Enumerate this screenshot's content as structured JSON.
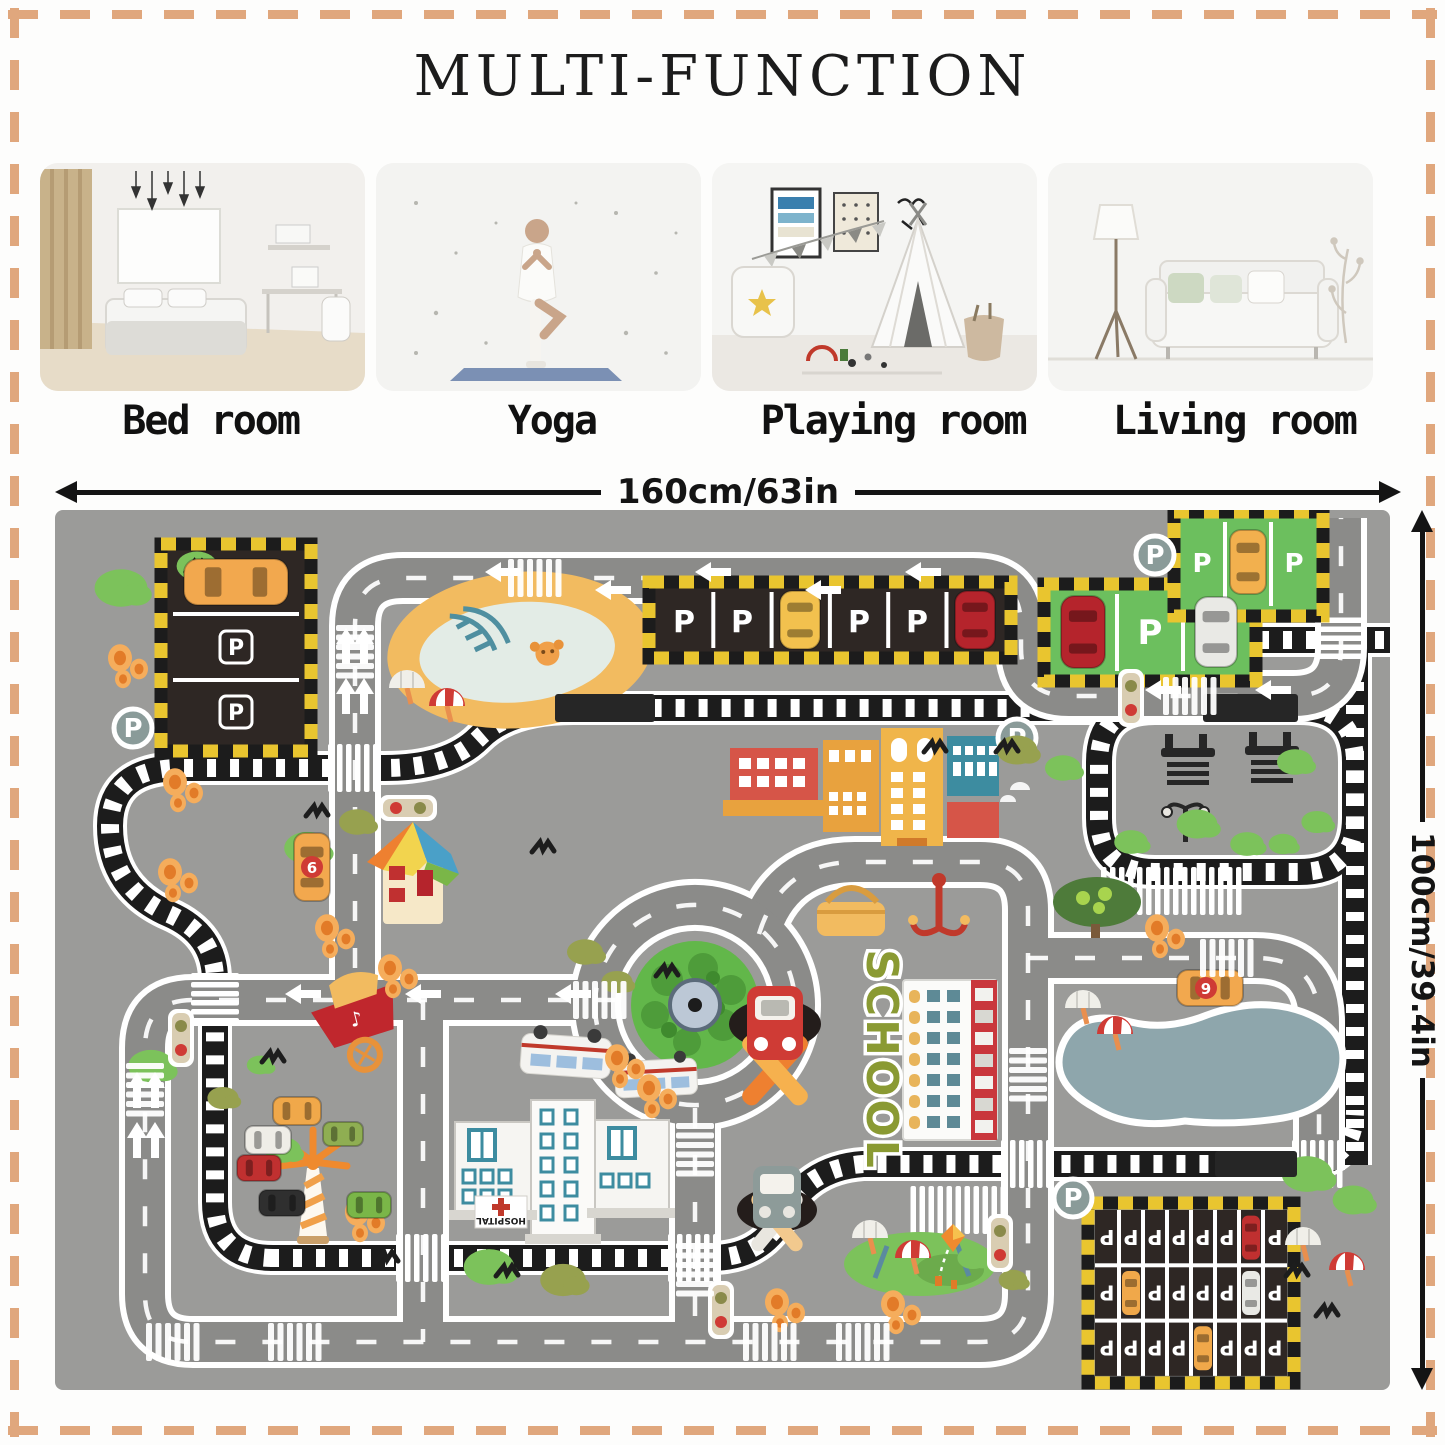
{
  "page": {
    "title": "MULTI-FUNCTION"
  },
  "rooms": [
    {
      "label": "Bed room"
    },
    {
      "label": "Yoga"
    },
    {
      "label": "Playing room"
    },
    {
      "label": "Living room"
    }
  ],
  "dimensions": {
    "width_label": "160cm/63in",
    "height_label": "100cm/39.4in"
  },
  "colors": {
    "frame_dash": "#e0a77d",
    "title_text": "#1c1c1c",
    "mat_bg": "#9b9b99",
    "road": "#8b8b89",
    "road_line": "#ffffff",
    "track": "#1c1c1c",
    "hazard_yellow": "#e9c52f",
    "parking_dark": "#2e2724",
    "parking_green": "#6cbf5e",
    "pond_sand": "#f2bb60",
    "pond_water": "#e3ece6",
    "lake": "#8ea6ac",
    "grass": "#7cc25b",
    "olive": "#97a14f",
    "fruit_orange": "#f0a04a",
    "school_red": "#c9373c",
    "school_text_green": "#8a9a33",
    "hospital_teal": "#3d8ca0",
    "car_yellow": "#f2b04e",
    "car_red": "#b5242c"
  },
  "mat": {
    "p_letter": "P",
    "school_text": "SCHOOL",
    "hospital_text": "HOSPITAL",
    "car_numbers": {
      "house_car": "6",
      "race_car": "9"
    },
    "roads": [
      "M 300,505 L 300,116 Q 300,68 348,68 L 918,68 Q 966,68 966,116 L 966,138 Q 966,186 1014,186 L 1238,186 Q 1286,186 1286,138 L 1286,8",
      "M 560,490 L 138,490 Q 90,490 90,538 L 90,784 Q 90,832 138,832 L 925,832 Q 973,832 973,784 L 973,700",
      "M 368,490 L 368,832",
      "M 640,598 L 640,832",
      "M 704,424 Q 726,352 800,352 L 925,352 Q 973,352 973,400 L 973,710",
      "M 973,448 L 1200,448 Q 1264,448 1264,512 L 1264,660",
      "M 540,495 a 100,100 0 1 0 200,0 a 100,100 0 1 0 -200,0"
    ],
    "tracks": [
      "M 218,748 Q 160,748 160,692 L 160,470 Q 160,424 114,404 Q 55,378 55,316 Q 55,258 126,258 L 330,258 Q 394,258 424,228 Q 454,198 518,198 L 1252,198",
      "M 1100,198 Q 1044,198 1044,252 L 1044,308 Q 1044,362 1100,362 L 1244,362 Q 1300,362 1300,308 L 1300,252 Q 1300,198 1244,198",
      "M 1205,130 L 1340,130",
      "M 1205,130 Q 1128,136 1108,164 Q 1094,192 1136,198",
      "M 1300,126 L 1300,655",
      "M 215,748 L 656,748 Q 704,748 726,710 Q 750,658 808,654 L 1246,654 Q 1300,654 1300,600"
    ],
    "crossings": [
      [
        300,
        258,
        0,
        6
      ],
      [
        160,
        490,
        90,
        6
      ],
      [
        640,
        748,
        0,
        6
      ],
      [
        973,
        654,
        0,
        6
      ],
      [
        1264,
        654,
        0,
        6
      ],
      [
        368,
        748,
        0,
        6
      ],
      [
        1286,
        130,
        90,
        5
      ],
      [
        1118,
        381,
        0,
        16
      ],
      [
        905,
        700,
        0,
        11
      ]
    ],
    "crosswalks": [
      [
        300,
        142,
        90
      ],
      [
        480,
        68,
        0
      ],
      [
        1135,
        186,
        0
      ],
      [
        545,
        490,
        0
      ],
      [
        90,
        580,
        90
      ],
      [
        640,
        640,
        90
      ],
      [
        973,
        565,
        90
      ],
      [
        1172,
        448,
        0
      ],
      [
        715,
        832,
        0
      ],
      [
        808,
        832,
        0
      ],
      [
        118,
        832,
        0
      ],
      [
        240,
        832,
        0
      ],
      [
        640,
        760,
        90
      ]
    ],
    "arrows": [
      [
        430,
        62,
        0
      ],
      [
        640,
        62,
        0
      ],
      [
        850,
        62,
        0
      ],
      [
        540,
        80,
        0
      ],
      [
        750,
        80,
        0
      ],
      [
        1090,
        180,
        0
      ],
      [
        1200,
        180,
        0
      ],
      [
        230,
        484,
        0
      ],
      [
        350,
        484,
        0
      ],
      [
        500,
        484,
        0
      ],
      [
        291,
        118,
        90
      ],
      [
        309,
        118,
        90
      ],
      [
        291,
        168,
        90
      ],
      [
        309,
        168,
        90
      ],
      [
        82,
        562,
        90
      ],
      [
        100,
        562,
        90
      ],
      [
        82,
        612,
        90
      ],
      [
        100,
        612,
        90
      ]
    ],
    "bushes": [
      [
        66,
        78,
        22,
        "g"
      ],
      [
        142,
        56,
        17,
        "g"
      ],
      [
        252,
        338,
        19,
        "g"
      ],
      [
        302,
        312,
        15,
        "o"
      ],
      [
        96,
        556,
        19,
        "g"
      ],
      [
        168,
        588,
        13,
        "o"
      ],
      [
        434,
        757,
        21,
        "g"
      ],
      [
        508,
        770,
        19,
        "o"
      ],
      [
        962,
        240,
        17,
        "o"
      ],
      [
        1008,
        258,
        15,
        "g"
      ],
      [
        1142,
        314,
        17,
        "g"
      ],
      [
        1192,
        334,
        14,
        "g"
      ],
      [
        1252,
        664,
        21,
        "g"
      ],
      [
        1298,
        690,
        17,
        "g"
      ],
      [
        530,
        442,
        15,
        "o"
      ],
      [
        562,
        472,
        13,
        "o"
      ],
      [
        228,
        640,
        15,
        "g"
      ],
      [
        205,
        555,
        11,
        "g"
      ],
      [
        1240,
        252,
        15,
        "g"
      ],
      [
        1262,
        312,
        13,
        "g"
      ],
      [
        1076,
        332,
        14,
        "g"
      ],
      [
        1228,
        334,
        12,
        "g"
      ],
      [
        918,
        748,
        13,
        "g"
      ],
      [
        958,
        770,
        12,
        "o"
      ]
    ],
    "fruits": [
      [
        115,
        362
      ],
      [
        272,
        418
      ],
      [
        335,
        458
      ],
      [
        562,
        548
      ],
      [
        594,
        578
      ],
      [
        1102,
        418
      ],
      [
        722,
        792
      ],
      [
        838,
        794
      ],
      [
        302,
        702
      ],
      [
        120,
        272
      ],
      [
        65,
        148
      ]
    ],
    "birds": [
      [
        142,
        58
      ],
      [
        262,
        302
      ],
      [
        452,
        762
      ],
      [
        332,
        748
      ],
      [
        218,
        548
      ],
      [
        1242,
        762
      ],
      [
        1272,
        802
      ],
      [
        952,
        238
      ],
      [
        612,
        462
      ],
      [
        880,
        238
      ],
      [
        488,
        338
      ]
    ],
    "umbrellas": [
      [
        352,
        178,
        "w"
      ],
      [
        392,
        196,
        "r"
      ],
      [
        1028,
        498,
        "w"
      ],
      [
        1060,
        524,
        "r"
      ],
      [
        815,
        728,
        "w"
      ],
      [
        858,
        748,
        "r"
      ],
      [
        1248,
        735,
        "w"
      ],
      [
        1292,
        760,
        "r"
      ]
    ],
    "traffic_lights": [
      [
        126,
        528,
        0
      ],
      [
        1076,
        188,
        0
      ],
      [
        945,
        733,
        0
      ],
      [
        666,
        800,
        0
      ],
      [
        353,
        298,
        1
      ]
    ],
    "train_blocks": [
      [
        500,
        184,
        100,
        28
      ],
      [
        1148,
        184,
        95,
        28
      ],
      [
        1160,
        641,
        82,
        26
      ]
    ],
    "cars": [
      {
        "x": 129,
        "y": 49,
        "w": 104,
        "h": 46,
        "c": "#f2a84e"
      },
      {
        "x": 725,
        "y": 81,
        "w": 40,
        "h": 58,
        "c": "#f2c14e"
      },
      {
        "x": 900,
        "y": 81,
        "w": 40,
        "h": 58,
        "c": "#b5242c"
      },
      {
        "x": 1006,
        "y": 86,
        "w": 44,
        "h": 72,
        "c": "#b5242c"
      },
      {
        "x": 1140,
        "y": 87,
        "w": 42,
        "h": 70,
        "c": "#e9e9e5"
      },
      {
        "x": 1175,
        "y": 20,
        "w": 36,
        "h": 64,
        "c": "#f2b04e"
      },
      {
        "x": 239,
        "y": 323,
        "w": 36,
        "h": 68,
        "c": "#f2a84e"
      },
      {
        "x": 1122,
        "y": 460,
        "w": 66,
        "h": 36,
        "c": "#f2a84e"
      },
      {
        "x": 182,
        "y": 645,
        "w": 44,
        "h": 26,
        "c": "#c03030"
      },
      {
        "x": 204,
        "y": 680,
        "w": 46,
        "h": 26,
        "c": "#2f2f2f"
      },
      {
        "x": 292,
        "y": 682,
        "w": 44,
        "h": 26,
        "c": "#7ab648"
      },
      {
        "x": 218,
        "y": 587,
        "w": 48,
        "h": 28,
        "c": "#f0a84a"
      },
      {
        "x": 268,
        "y": 612,
        "w": 40,
        "h": 24,
        "c": "#8fae52"
      },
      {
        "x": 190,
        "y": 616,
        "w": 46,
        "h": 28,
        "c": "#efede7"
      }
    ],
    "p_signs": [
      [
        78,
        218
      ],
      [
        962,
        228
      ],
      [
        1100,
        45
      ],
      [
        1018,
        688
      ]
    ],
    "garage": {
      "x": 1040,
      "y": 700,
      "cols": 8,
      "rows": 3,
      "cellw": 24,
      "cellh": 55.3,
      "letter": "P",
      "cars": [
        {
          "r": 0,
          "c": 6,
          "col": "#c03030"
        },
        {
          "r": 1,
          "c": 1,
          "col": "#f0a84a"
        },
        {
          "r": 1,
          "c": 6,
          "col": "#e9e9e5"
        },
        {
          "r": 2,
          "c": 4,
          "col": "#f0a84a"
        }
      ]
    }
  }
}
